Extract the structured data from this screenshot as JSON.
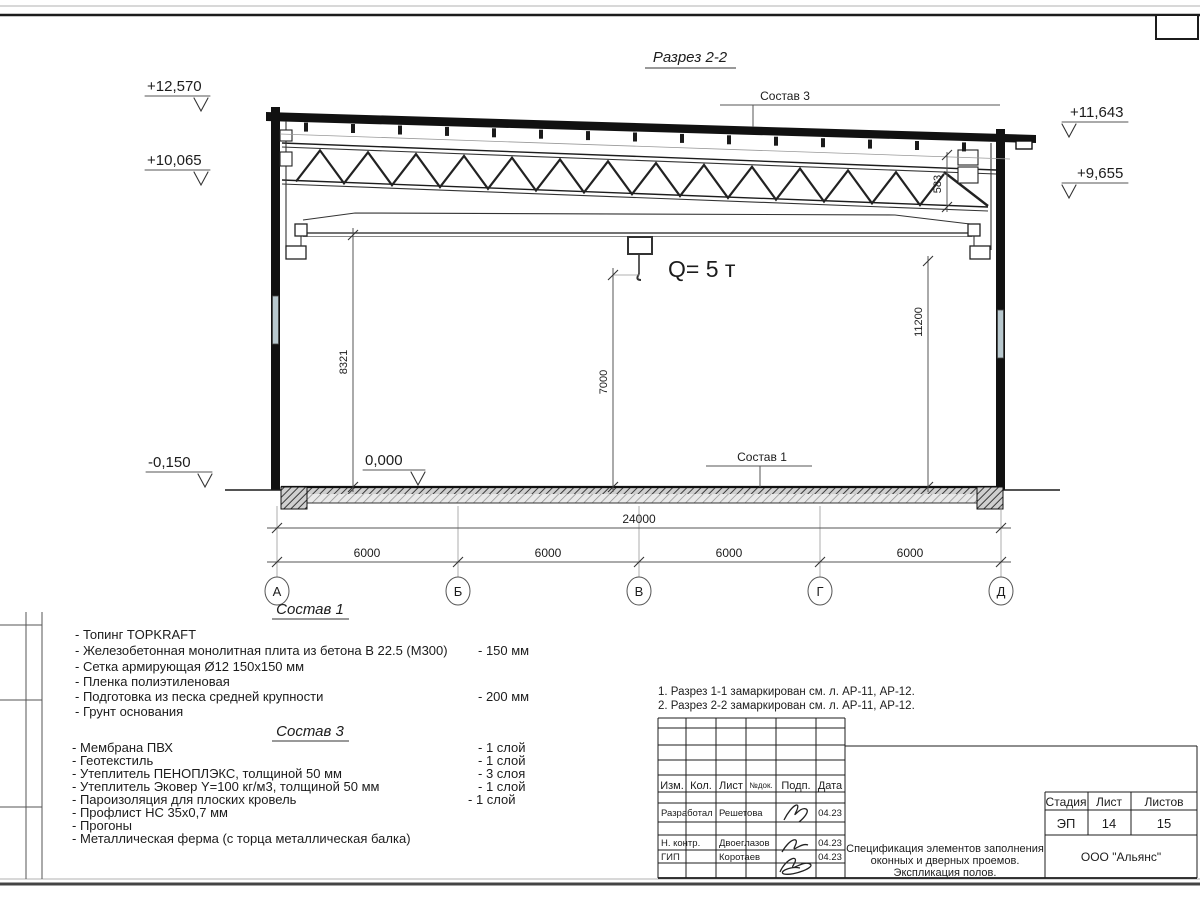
{
  "drawing": {
    "title": "Разрез 2-2",
    "labels": {
      "sostav3_top": "Состав 3",
      "sostav1_floor": "Состав 1",
      "crane": "Q= 5 т"
    },
    "levels": {
      "left_top": "+12,570",
      "left_mid": "+10,065",
      "right_top": "+11,643",
      "right_mid": "+9,655",
      "floor": "0,000",
      "ground": "-0,150"
    },
    "dims": {
      "total": "24000",
      "bay1": "6000",
      "bay2": "6000",
      "bay3": "6000",
      "bay4": "6000",
      "h_left": "8321",
      "h_mid": "7000",
      "h_right": "11200",
      "truss_end": "583"
    },
    "axes": {
      "a1": "А",
      "a2": "Б",
      "a3": "В",
      "a4": "Г",
      "a5": "Д"
    }
  },
  "composition1": {
    "heading": "Состав 1",
    "items": [
      {
        "text": "- Топинг TOPKRAFT",
        "value": ""
      },
      {
        "text": "- Железобетонная  монолитная плита из бетона  В 22.5 (М300)",
        "value": "- 150 мм"
      },
      {
        "text": "- Сетка армирующая Ø12 150х150 мм",
        "value": ""
      },
      {
        "text": "- Пленка полиэтиленовая",
        "value": ""
      },
      {
        "text": "- Подготовка из песка средней  крупности",
        "value": "- 200 мм"
      },
      {
        "text": "- Грунт основания",
        "value": ""
      }
    ]
  },
  "composition3": {
    "heading": "Состав 3",
    "items": [
      {
        "text": "- Мембрана ПВХ",
        "value": "- 1 слой"
      },
      {
        "text": "- Геотекстиль",
        "value": "- 1 слой"
      },
      {
        "text": "- Утеплитель ПЕНОПЛЭКС, толщиной 50 мм",
        "value": "- 3 слоя"
      },
      {
        "text": "- Утеплитель Эковер Y=100 кг/м3, толщиной 50 мм",
        "value": "- 1 слой"
      },
      {
        "text": "- Пароизоляция для плоских кровель",
        "value": "- 1 слой"
      },
      {
        "text": "- Профлист НС 35х0,7 мм",
        "value": ""
      },
      {
        "text": "- Прогоны",
        "value": ""
      },
      {
        "text": "- Металлическая ферма (с торца металлическая балка)",
        "value": ""
      }
    ]
  },
  "notes": {
    "n1": "1. Разрез 1-1 замаркирован см. л. АР-11, АР-12.",
    "n2": "2. Разрез 2-2 замаркирован см. л. АР-11, АР-12."
  },
  "titleblock": {
    "cols": {
      "c1": "Изм.",
      "c2": "Кол.",
      "c3": "Лист",
      "c4": "№док.",
      "c5": "Подп.",
      "c6": "Дата"
    },
    "rows": {
      "r1": {
        "role": "Разработал",
        "name": "Решетова",
        "date": "04.23"
      },
      "r2": {
        "role": "Н. контр.",
        "name": "Двоеглазов",
        "date": "04.23"
      },
      "r3": {
        "role": "ГИП",
        "name": "Коротаев",
        "date": "04.23"
      }
    },
    "stage": {
      "l1": "Стадия",
      "l2": "Лист",
      "l3": "Листов",
      "v1": "ЭП",
      "v2": "14",
      "v3": "15"
    },
    "doc_title": {
      "line1": "Спецификация элементов заполнения",
      "line2": "оконных и дверных проемов.",
      "line3": "Экспликация полов."
    },
    "company": "ООО \"Альянс\""
  }
}
